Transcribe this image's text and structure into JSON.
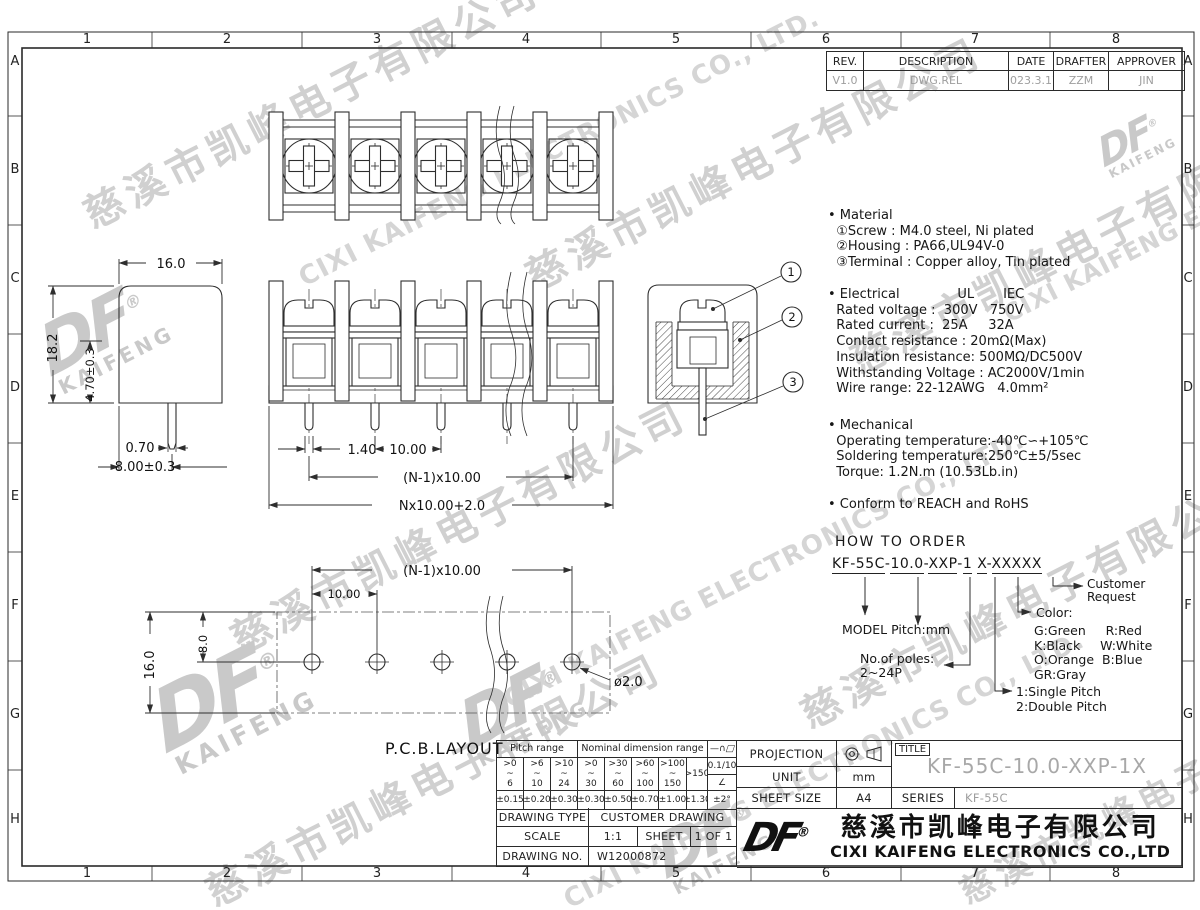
{
  "sheet": {
    "cols": [
      "1",
      "2",
      "3",
      "4",
      "5",
      "6",
      "7",
      "8"
    ],
    "rows": [
      "A",
      "B",
      "C",
      "D",
      "E",
      "F",
      "G",
      "H"
    ]
  },
  "revision": {
    "headers": [
      "REV.",
      "DESCRIPTION",
      "DATE",
      "DRAFTER",
      "APPROVER"
    ],
    "values": [
      "V1.0",
      "DWG.REL",
      "2023.3.17",
      "ZZM",
      "JIN"
    ]
  },
  "notes": {
    "material": [
      "• Material",
      "  ①Screw : M4.0 steel, Ni plated",
      "  ②Housing : PA66,UL94V-0",
      "  ③Terminal : Copper alloy, Tin plated"
    ],
    "electrical": [
      "• Electrical              UL       IEC",
      "  Rated voltage :  300V   750V",
      "  Rated current :  25A     32A",
      "  Contact resistance : 20mΩ(Max)",
      "  Insulation resistance: 500MΩ/DC500V",
      "  Withstanding Voltage : AC2000V/1min",
      "  Wire range: 22-12AWG   4.0mm²"
    ],
    "mechanical": [
      "• Mechanical",
      "  Operating temperature:-40℃∽+105℃",
      "  Soldering temperature:250℃±5/5sec",
      "  Torque: 1.2N.m (10.53Lb.in)"
    ],
    "conform": "• Conform to REACH and RoHS"
  },
  "order": {
    "title": "HOW TO ORDER",
    "p1": "KF-55C",
    "d1": "-",
    "p2": "10.0",
    "d2": "-",
    "p3": "XXP",
    "d3": "-",
    "p4": "1",
    "p5": "X",
    "d4": "-",
    "p6": "XXXXX",
    "customer": [
      "Customer",
      "Request"
    ],
    "color_title": "Color:",
    "colors": [
      "G:Green     R:Red",
      "K:Black     W:White",
      "O:Orange  B:Blue",
      "GR:Gray"
    ],
    "model": "MODEL  Pitch:mm",
    "poles": [
      "No.of poles:",
      "2~24P"
    ],
    "pitch_opts": [
      "1:Single Pitch",
      "2:Double Pitch"
    ]
  },
  "dims": {
    "top_w": "16.0",
    "height": "18.2",
    "h_part": "4.70±0.3",
    "pin_w": "0.70",
    "pin_off": "8.00±0.3",
    "fv_pin": "1.40",
    "fv_pitch": "10.00",
    "fv_span": "(N-1)x10.00",
    "fv_total": "Nx10.00+2.0",
    "pcb_span": "(N-1)x10.00",
    "pcb_pitch": "10.00",
    "pcb_8": "8.0",
    "pcb_16": "16.0",
    "pcb_hole": "ø2.0",
    "pcb_label": "P.C.B.LAYOUT",
    "callout_1": "1",
    "callout_2": "2",
    "callout_3": "3"
  },
  "tol_table": {
    "pitch_header": "Pitch range",
    "nominal_header": "Nominal dimension range",
    "sym_line": "—",
    "sym_arc": "∩",
    "sym_para": "□",
    "ranges": [
      [
        ">0",
        "~",
        "6"
      ],
      [
        ">6",
        "~",
        "10"
      ],
      [
        ">10",
        "~",
        "24"
      ],
      [
        ">0",
        "~",
        "30"
      ],
      [
        ">30",
        "~",
        "60"
      ],
      [
        ">60",
        "~",
        "100"
      ],
      [
        ">100",
        "~",
        "150"
      ]
    ],
    "range_last": ">150",
    "flat_val": "0.1/10",
    "angle_sym": "∠",
    "tols": [
      "±0.15",
      "±0.20",
      "±0.30",
      "±0.30",
      "±0.50",
      "±0.70",
      "±1.00",
      "±1.30"
    ],
    "angle_tol": "±2°"
  },
  "info": {
    "drawing_type_label": "DRAWING TYPE",
    "drawing_type": "CUSTOMER DRAWING",
    "scale_label": "SCALE",
    "scale": "1:1",
    "sheet_label": "SHEET",
    "sheet": "1 OF 1",
    "drawing_no_label": "DRAWING NO.",
    "drawing_no": "W12000872"
  },
  "title_block": {
    "projection_label": "PROJECTION",
    "unit_label": "UNIT",
    "unit": "mm",
    "sheet_size_label": "SHEET SIZE",
    "sheet_size": "A4",
    "title_label": "TITLE",
    "title": "KF-55C-10.0-XXP-1X",
    "series_label": "SERIES",
    "series": "KF-55C",
    "logo": "DF",
    "reg": "®",
    "company_cn": "慈溪市凯峰电子有限公司",
    "company_en": "CIXI KAIFENG ELECTRONICS CO.,LTD"
  },
  "watermark": {
    "cn": "慈溪市凯峰电子有限公司",
    "en": "CIXI KAIFENG ELECTRONICS CO., LTD.",
    "logo": "DF",
    "logo_sub": "KAIFENG",
    "reg": "®"
  }
}
